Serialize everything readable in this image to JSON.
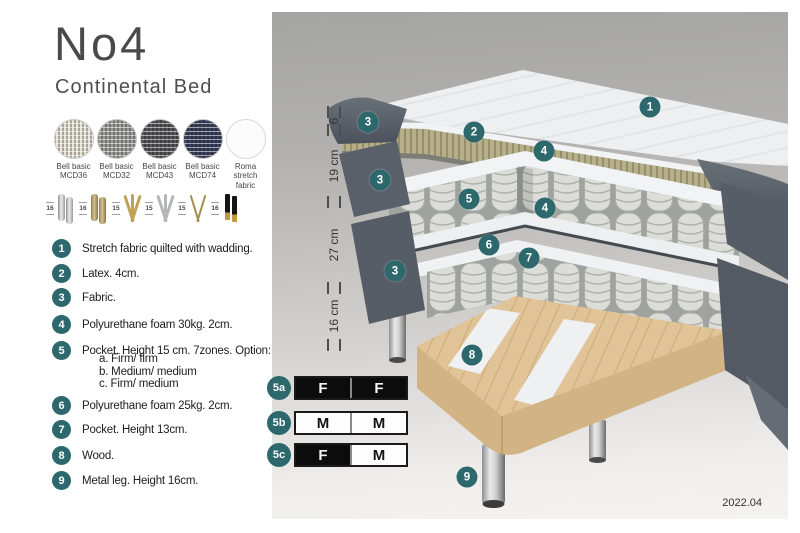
{
  "title": "No4",
  "subtitle": "Continental Bed",
  "fabric_swatches": [
    {
      "line1": "Bell basic",
      "line2": "MCD36"
    },
    {
      "line1": "Bell basic",
      "line2": "MCD32"
    },
    {
      "line1": "Bell basic",
      "line2": "MCD43"
    },
    {
      "line1": "Bell basic",
      "line2": "MCD74"
    },
    {
      "line1": "Roma",
      "line2": "stretch fabric"
    }
  ],
  "leg_options": [
    {
      "height": "16",
      "style": "cylinder-chrome"
    },
    {
      "height": "16",
      "style": "cylinder-brass"
    },
    {
      "height": "15",
      "style": "twist-gold"
    },
    {
      "height": "15",
      "style": "twist-silver"
    },
    {
      "height": "15",
      "style": "hairpin-brass"
    },
    {
      "height": "16",
      "style": "taper-black-gold"
    }
  ],
  "parts_list": [
    {
      "num": "1",
      "text": "Stretch fabric quilted with wadding."
    },
    {
      "num": "2",
      "text": "Latex. 4cm."
    },
    {
      "num": "3",
      "text": "Fabric."
    },
    {
      "num": "4",
      "text": "Polyurethane foam 30kg. 2cm."
    },
    {
      "num": "5",
      "text": "Pocket. Height 15 cm. 7zones. Option:",
      "options": [
        "a. Firm/ firm",
        "b. Medium/ medium",
        "c. Firm/ medium"
      ]
    },
    {
      "num": "6",
      "text": "Polyurethane foam 25kg. 2cm."
    },
    {
      "num": "7",
      "text": "Pocket. Height 13cm."
    },
    {
      "num": "8",
      "text": "Wood."
    },
    {
      "num": "9",
      "text": "Metal leg. Height 16cm."
    }
  ],
  "diagram": {
    "dimension_labels": [
      "6",
      "19 cm",
      "27 cm",
      "16 cm"
    ],
    "callouts": [
      {
        "label": "1",
        "x": 378,
        "y": 95
      },
      {
        "label": "2",
        "x": 202,
        "y": 120
      },
      {
        "label": "3",
        "x": 96,
        "y": 110
      },
      {
        "label": "4",
        "x": 272,
        "y": 139
      },
      {
        "label": "3",
        "x": 108,
        "y": 168
      },
      {
        "label": "5",
        "x": 197,
        "y": 187
      },
      {
        "label": "4",
        "x": 273,
        "y": 196
      },
      {
        "label": "6",
        "x": 217,
        "y": 233
      },
      {
        "label": "7",
        "x": 257,
        "y": 246
      },
      {
        "label": "3",
        "x": 123,
        "y": 259
      },
      {
        "label": "8",
        "x": 200,
        "y": 343
      },
      {
        "label": "9",
        "x": 195,
        "y": 465
      }
    ],
    "firmness_options": [
      {
        "id": "5a",
        "left": {
          "letter": "F",
          "tone": "dark"
        },
        "right": {
          "letter": "F",
          "tone": "dark"
        }
      },
      {
        "id": "5b",
        "left": {
          "letter": "M",
          "tone": "light"
        },
        "right": {
          "letter": "M",
          "tone": "light"
        }
      },
      {
        "id": "5c",
        "left": {
          "letter": "F",
          "tone": "dark"
        },
        "right": {
          "letter": "M",
          "tone": "light"
        }
      }
    ],
    "version": "2022.04"
  },
  "colors": {
    "accent_teal": "#2d686d",
    "fabric_dark": "#565c66",
    "latex": "#b4ad88",
    "wood": "#dfc398"
  }
}
